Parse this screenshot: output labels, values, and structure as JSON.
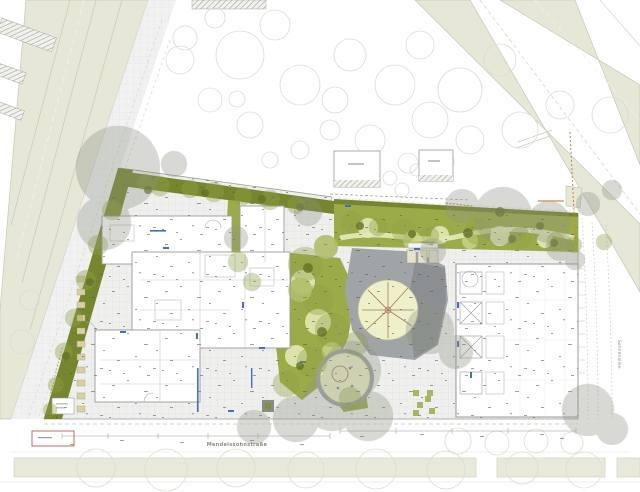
{
  "labels": {
    "bottom_street": "Mendelssohnstraße",
    "right_street": "Sonnenallee"
  },
  "colors": {
    "road": "#e6e7d6",
    "sidewalk": "#e9e9db",
    "hedge": "#76862f",
    "lawn": "#9cab4a",
    "lawn_light": "#cbd485",
    "lawn_pale": "#e3e8b5",
    "plaza": "#a0a4a7",
    "plaza_dark": "#8c9093",
    "play_sand": "#eef0ca",
    "canopy_gray": "#8e9383",
    "canopy_green": "#8fa146",
    "building_fill": "#ffffff",
    "accent_orange": "#c08a3e",
    "accent_blue": "#4a6bc5",
    "accent_red": "#b04a3a"
  }
}
